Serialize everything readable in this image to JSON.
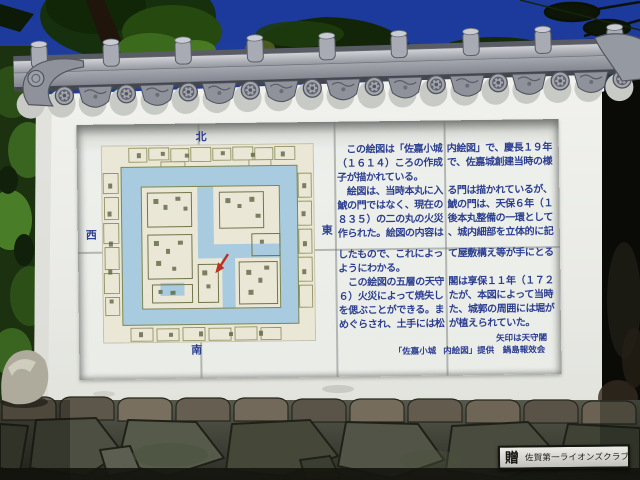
{
  "monument": {
    "panel": {
      "map": {
        "compass": {
          "north": "北",
          "south": "南",
          "east": "東",
          "west": "西"
        },
        "arrow_color": "#bf3022",
        "moat_color": "#a9cbdf",
        "paper_color": "#ebe7d6"
      },
      "text": {
        "color": "#2c3e90",
        "lines": [
          {
            "left": "　この絵図は「佐嘉小城",
            "right": "内絵図」で、慶長１９年"
          },
          {
            "left": "（１６１４）ころの作成",
            "right": "で、佐嘉城創建当時の様"
          },
          {
            "left": "子が描かれている。",
            "right": ""
          },
          {
            "left": "　絵図は、当時本丸に入",
            "right": "る門は描かれているが、"
          },
          {
            "left": "鯱の門ではなく、現在の",
            "right": "鯱の門は、天保６年（１"
          },
          {
            "left": "８３５）の二の丸の火災",
            "right": "後本丸整備の一環として"
          },
          {
            "left": "作られた。絵図の内容は",
            "right": "、城内細部を立体的に記"
          },
          {
            "left": "したもので、これによっ",
            "right": "て屋敷構え等が手にとる"
          },
          {
            "left": "ようにわかる。",
            "right": ""
          },
          {
            "left": "　この絵図の五層の天守",
            "right": "閣は享保１１年（１７２"
          },
          {
            "left": "６）火災によって焼失し",
            "right": "たが、本図によって当時"
          },
          {
            "left": "を偲ぶことができる。ま",
            "right": "た、城郭の周囲には堀が"
          },
          {
            "left": "めぐらされ、土手には松",
            "right": "が植えられていた。"
          }
        ],
        "note_arrow": "矢印は天守閣",
        "credit": {
          "left": "「佐嘉小城",
          "right": "内絵図」提供　鍋島報效会"
        }
      }
    },
    "plaque": {
      "prefix": "贈",
      "name": "佐賀第一ライオンズクラブ"
    }
  },
  "colors": {
    "sky": "#1c3a9c",
    "wall": "#ecedе8",
    "panel_text": "#2c3e90",
    "moat": "#a9cbdf",
    "arrow": "#bf3022",
    "roof_tile": "#8f929b",
    "stone_base": "#4c4f42"
  }
}
